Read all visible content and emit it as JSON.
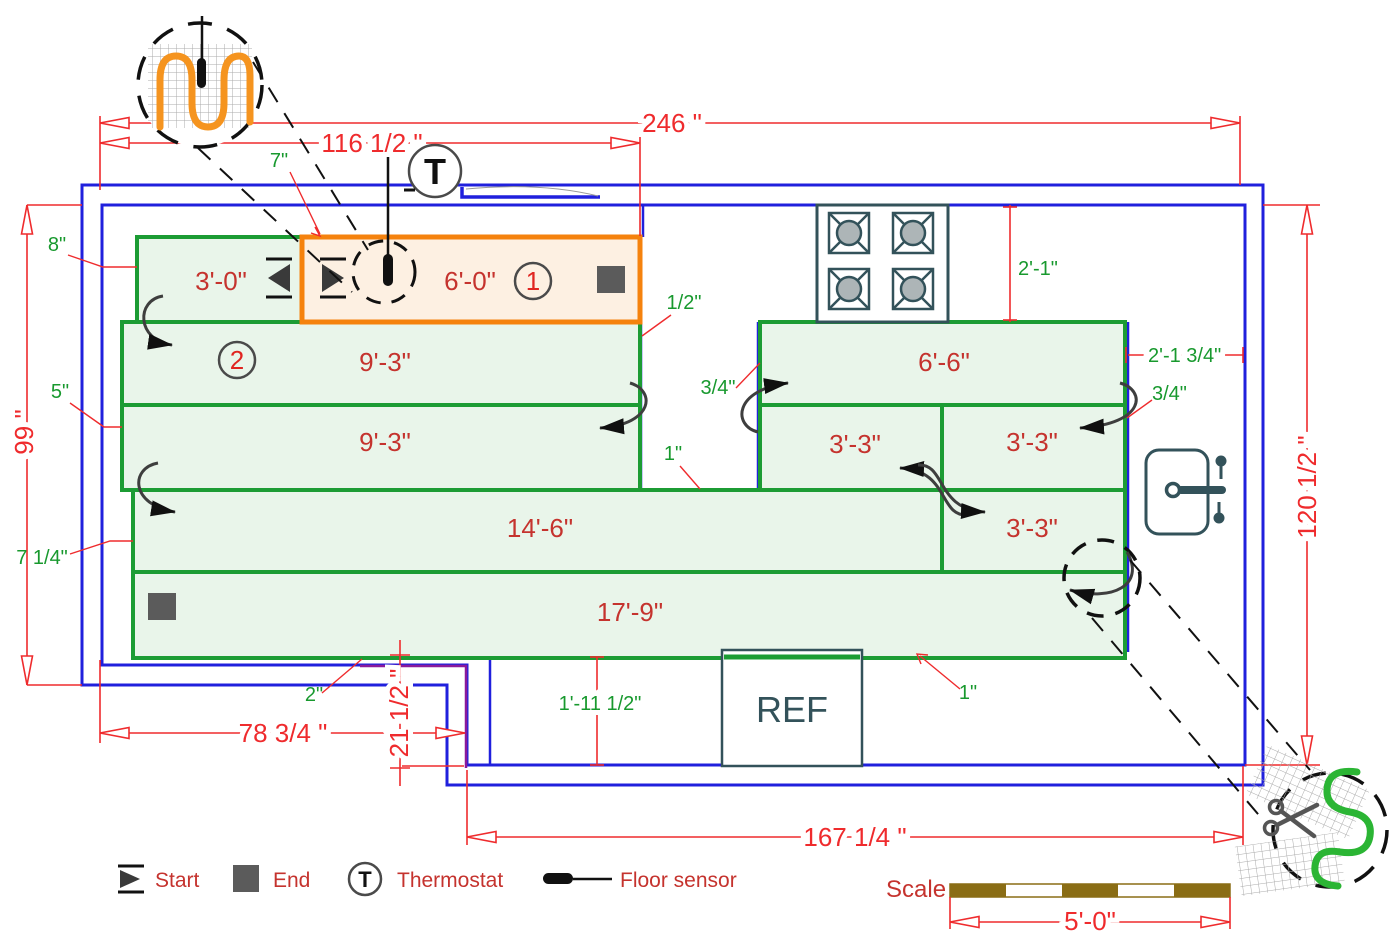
{
  "colors": {
    "wall_blue": "#2020DD",
    "mat_green_border": "#1C9C34",
    "mat_green_fill": "#E9F5EA",
    "zone1_orange_border": "#F5820D",
    "zone1_orange_fill": "#FDF0E2",
    "dimension_red": "#EF2B2D",
    "label_red": "#C5332E",
    "note_green": "#18992E",
    "scale_brown": "#8A6D15",
    "lead_purple": "#8B1A9B",
    "appliance_slate": "#33525A",
    "cable_orange": "#F5941F",
    "cable_green": "#2BB534"
  },
  "dimensions": {
    "total_width": "246 \"",
    "left_width": "116 1/2 \"",
    "left_height": "99 \"",
    "right_height": "120 1/2 \"",
    "bottom_left_width": "78 3/4 \"",
    "counter_depth": "21 1/2 \"",
    "bottom_right_width": "167 1/4 \"",
    "scale_length": "5'-0\""
  },
  "clearances": {
    "top_gap": "7\"",
    "left_gap_top": "8\"",
    "left_gap_mid": "5\"",
    "left_gap_bottom": "7 1/4\"",
    "bottom_gap": "2\"",
    "island_left": "1/2\"",
    "island_right": "3/4\"",
    "island_bottom": "1\"",
    "stove_offset": "2'-1\"",
    "right_offset": "2'-1 3/4\"",
    "right_gap": "3/4\"",
    "bottom_right_gap": "1\"",
    "counter_width": "1'-11 1/2\""
  },
  "mats": {
    "m_3_0": "3'-0\"",
    "m_6_0": "6'-0\"",
    "m_9_3_a": "9'-3\"",
    "m_9_3_b": "9'-3\"",
    "m_14_6": "14'-6\"",
    "m_17_9": "17'-9\"",
    "m_6_6": "6'-6\"",
    "m_3_3_a": "3'-3\"",
    "m_3_3_b": "3'-3\"",
    "m_3_3_c": "3'-3\"",
    "zone1_number": "1",
    "zone2_number": "2"
  },
  "appliances": {
    "refrigerator": "REF"
  },
  "thermostat": {
    "symbol": "T"
  },
  "legend": {
    "start": "Start",
    "end": "End",
    "thermostat": "Thermostat",
    "floor_sensor": "Floor sensor",
    "scale_label": "Scale"
  },
  "icons": {
    "start_marker": "right-triangle-with-bars",
    "end_marker": "filled-gray-square",
    "thermostat": "circled-T",
    "floor_sensor": "capsule-with-wire",
    "stove": "four-burner-cooktop",
    "sink": "basin-with-faucet",
    "scissors": "scissors",
    "heating_cable_detail": "serpentine-cable-on-mesh"
  }
}
